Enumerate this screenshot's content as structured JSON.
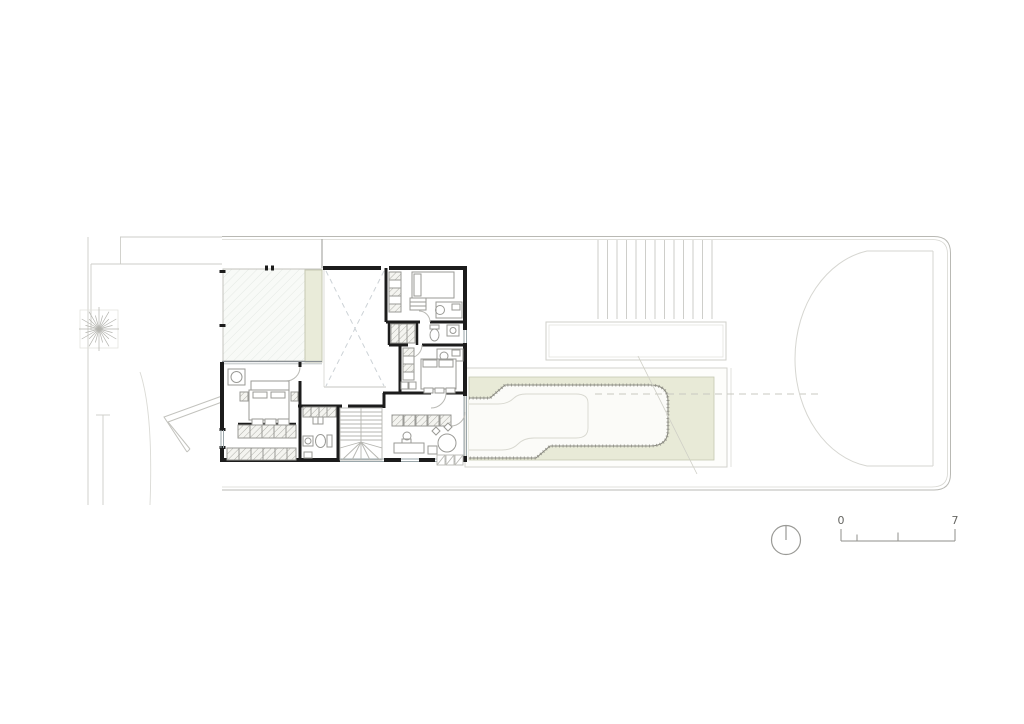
{
  "drawing": {
    "kind": "architectural ground floor plan",
    "scale_bar": {
      "start_label": "0",
      "end_label": "7"
    },
    "colors": {
      "paper": "#ffffff",
      "wall_black": "#1c1c1c",
      "line_light": "#c9c9c4",
      "line_medium": "#9a9a96",
      "glazing": "#9aa6aa",
      "garden_green_fill": "#e8ead7",
      "garden_green_border": "#c5c7b1",
      "planter_green_fill": "#e9ebd9"
    },
    "symbols": {
      "north_indicator": "circle-with-vertical-needle",
      "tree": "radial-line-starburst",
      "scale_bar": "ticked-ruler",
      "void_cross": "dashed-x",
      "stair": "u-stair-with-winders"
    }
  }
}
